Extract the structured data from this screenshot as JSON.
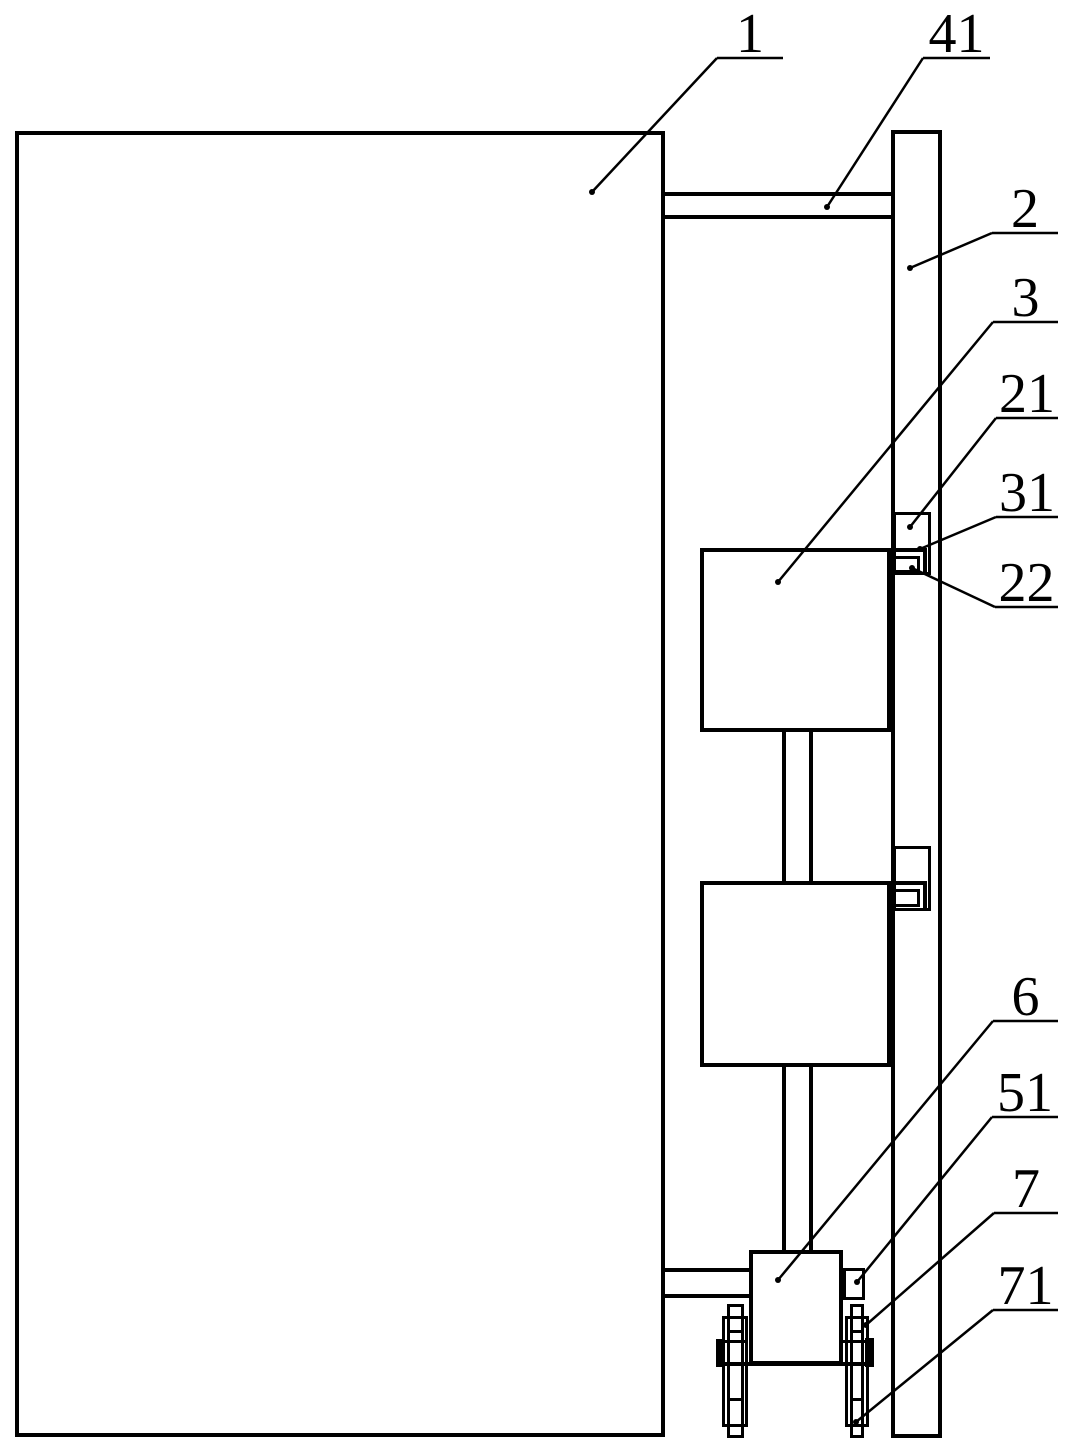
{
  "figure": {
    "colors": {
      "line": "#000000",
      "background": "#ffffff"
    }
  },
  "callouts": [
    {
      "text": "1",
      "underline": {
        "x1": 717,
        "x2": 783,
        "y": 58
      },
      "tip": {
        "x": 592,
        "y": 192
      }
    },
    {
      "text": "41",
      "underline": {
        "x1": 923,
        "x2": 990,
        "y": 58
      },
      "tip": {
        "x": 827,
        "y": 207
      }
    },
    {
      "text": "2",
      "underline": {
        "x1": 992,
        "x2": 1058,
        "y": 233
      },
      "tip": {
        "x": 910,
        "y": 268
      }
    },
    {
      "text": "3",
      "underline": {
        "x1": 993,
        "x2": 1058,
        "y": 322
      },
      "tip": {
        "x": 778,
        "y": 582
      }
    },
    {
      "text": "21",
      "underline": {
        "x1": 996,
        "x2": 1058,
        "y": 418
      },
      "tip": {
        "x": 910,
        "y": 527
      }
    },
    {
      "text": "31",
      "underline": {
        "x1": 996,
        "x2": 1058,
        "y": 517
      },
      "tip": {
        "x": 920,
        "y": 549
      }
    },
    {
      "text": "22",
      "underline": {
        "x1": 995,
        "x2": 1058,
        "y": 607
      },
      "tip": {
        "x": 912,
        "y": 568
      }
    },
    {
      "text": "6",
      "underline": {
        "x1": 993,
        "x2": 1058,
        "y": 1021
      },
      "tip": {
        "x": 778,
        "y": 1280
      }
    },
    {
      "text": "51",
      "underline": {
        "x1": 992,
        "x2": 1058,
        "y": 1117
      },
      "tip": {
        "x": 857,
        "y": 1282
      }
    },
    {
      "text": "7",
      "underline": {
        "x1": 994,
        "x2": 1058,
        "y": 1213
      },
      "tip": {
        "x": 866,
        "y": 1325
      }
    },
    {
      "text": "71",
      "underline": {
        "x1": 993,
        "x2": 1058,
        "y": 1310
      },
      "tip": {
        "x": 856,
        "y": 1422
      }
    }
  ]
}
